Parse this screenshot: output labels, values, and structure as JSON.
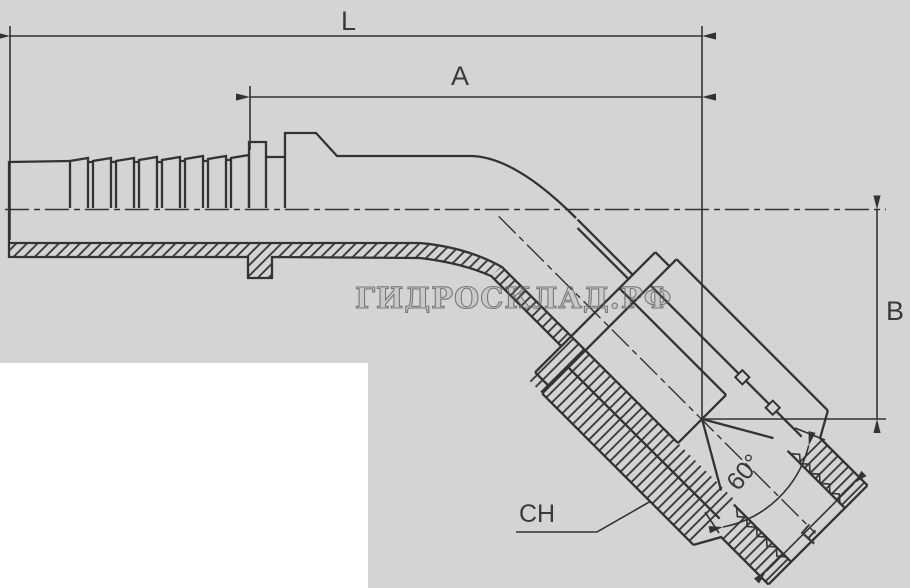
{
  "drawing": {
    "type": "technical-drawing",
    "subject": "45-degree elbow hose fitting with barbed tail and swivel nut, half-section view",
    "watermark": "ГИДРОСКЛАД.РФ",
    "labels": {
      "overall_length": "L",
      "tail_length": "A",
      "drop_height": "B",
      "wrench_size": "CH",
      "thread_size": "F",
      "cone_angle": "60°"
    },
    "colors": {
      "background": "#d4d4d4",
      "line": "#333333",
      "panel": "#ffffff",
      "watermark_stroke": "#616161"
    }
  }
}
